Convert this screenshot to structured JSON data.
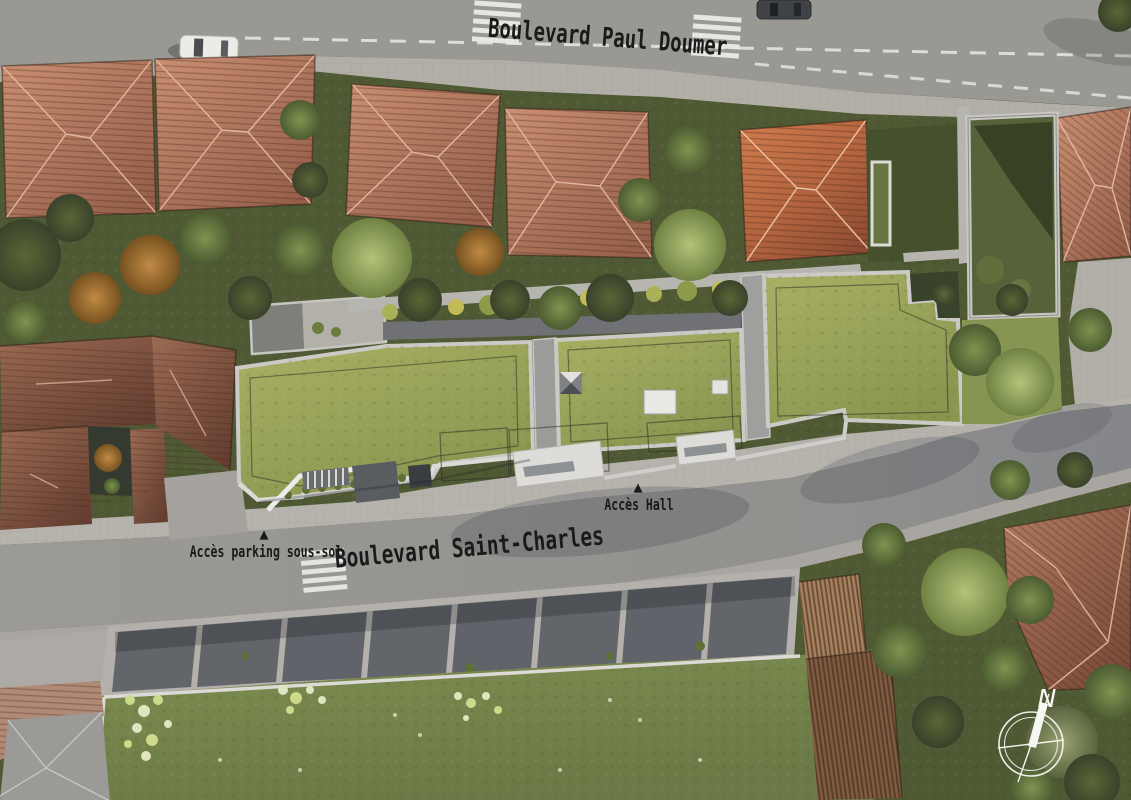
{
  "scene_type": "aerial architectural site plan rendering",
  "streets": {
    "paul_doumer": "Boulevard Paul Doumer",
    "saint_charles": "Boulevard Saint-Charles"
  },
  "access": {
    "hall_label": "Accès Hall",
    "parking_label": "Accès parking sous-sol",
    "marker_glyph": "▲"
  },
  "compass": {
    "north_label": "N"
  },
  "palette": {
    "road": "#9a9893",
    "sidewalk": "#b2afa9",
    "forecourt": "#b6b3ad",
    "lane_marking": "#e8e8e5",
    "roof_terracotta": "#b57c62",
    "roof_orange": "#c8714a",
    "roof_shadowed": "#8a5843",
    "green_roof": "#9aa65a",
    "green_roof_dark": "#55613a",
    "lawn": "#76854b",
    "garden": "#4f5933",
    "concrete_parapet": "#cbcac6",
    "patio_court": "#62666b",
    "pergola_wood": "#7e5c42",
    "label_text": "#1a1a1a",
    "compass_white": "#f6f6f3"
  }
}
